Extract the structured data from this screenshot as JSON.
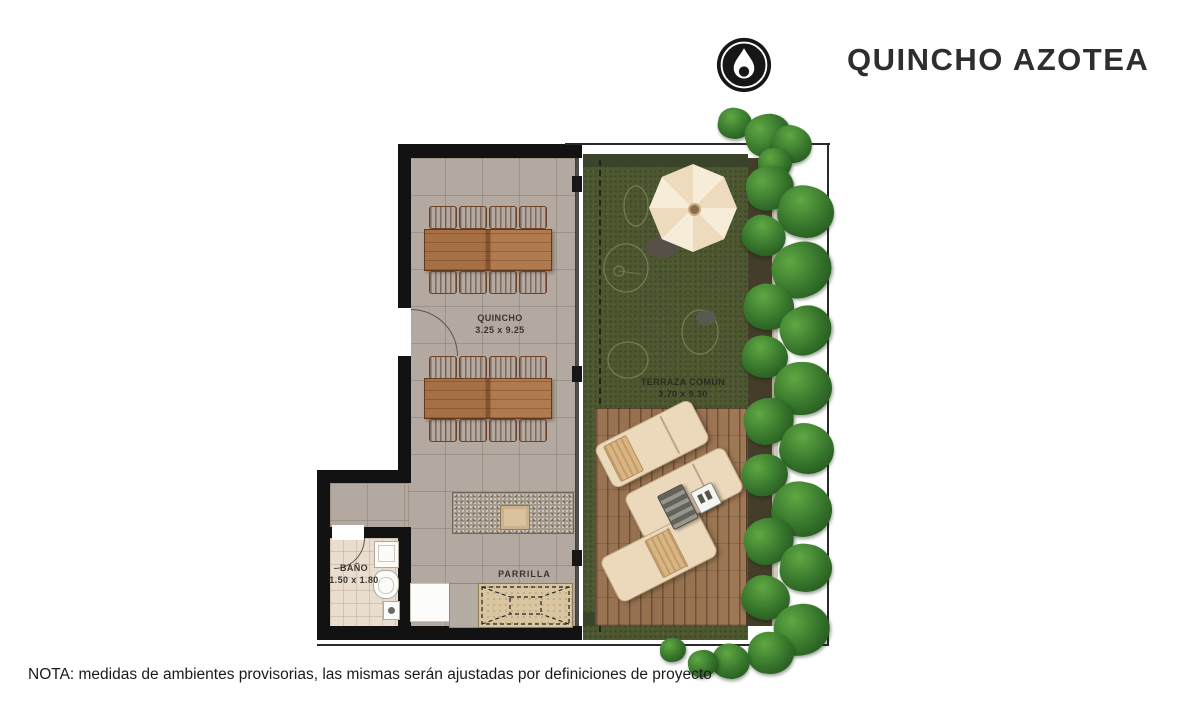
{
  "header": {
    "title": "QUINCHO AZOTEA",
    "logo_icon": "drop-in-circle-icon"
  },
  "rooms": {
    "quincho": {
      "label": "QUINCHO",
      "size": "3.25 x 9.25"
    },
    "terraza": {
      "label": "TERRAZA COMÚN",
      "size": "3.70 x 9.30"
    },
    "bano": {
      "label": "BAÑO",
      "size": "1.50 x 1.80"
    },
    "parrilla": {
      "label": "PARRILLA"
    }
  },
  "note": "NOTA: medidas de ambientes provisorias, las mismas serán ajustadas por definiciones de proyecto",
  "colors": {
    "wall": "#121212",
    "floor_tile": "#b4a9a0",
    "bathroom_floor": "#e9ddcf",
    "grass": "#4d5830",
    "deck_wood": "#96714f",
    "furniture_wood": "#a86f45",
    "umbrella": "#f3e4cb",
    "lounger": "#ecd9bc",
    "plants": "#2f6b26",
    "parrilla_counter": "#d9c6a1",
    "text": "#2e2e2e"
  }
}
